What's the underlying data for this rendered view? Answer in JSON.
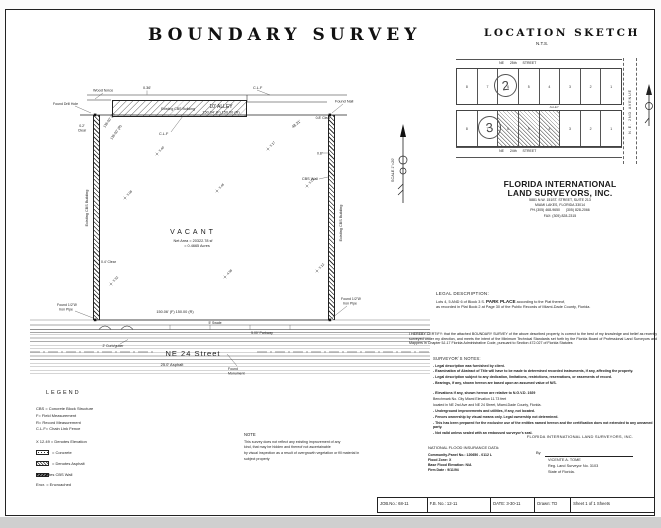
{
  "page": {
    "title": "BOUNDARY SURVEY"
  },
  "location_sketch": {
    "title": "LOCATION SKETCH",
    "nts": "N.T.S.",
    "street_top": "NE      25th      STREET",
    "street_bottom": "NE      24th      STREET",
    "alley": "ALLEY",
    "avenue": "N.E.  2ND  AVENUE",
    "block2_label": "2",
    "block3_label": "3",
    "block2_lots": [
      "8",
      "7",
      "6",
      "5",
      "4",
      "3",
      "2",
      "1"
    ],
    "block3_lots": [
      "8",
      "7",
      "6",
      "5",
      "4",
      "3",
      "2",
      "1"
    ]
  },
  "firm": {
    "name_line1": "FLORIDA INTERNATIONAL",
    "name_line2": "LAND SURVEYORS, INC.",
    "address1": "5881 N.W. 151ST. STREET, SUITE 213",
    "address2": "MIAMI LAKES, FLORIDA 33014",
    "phone": "PH.(305) 468-9650      (305) 828-2066",
    "fax": "FAX: (305) 828-2315"
  },
  "survey": {
    "scale": "SCALE 1\"=20'",
    "alley_label": "10'  ALLEY",
    "alley_dim": "150.04' (F)    150.00 (R)",
    "bottom_dim": "150.06' (F)    150.00 (R)",
    "west_dim_f": "135.00' (F)",
    "west_dim_r": "135.00' (R)",
    "vacant": "VACANT",
    "net_area_1": "Net Area = 20322.78 sf",
    "net_area_2": "= 0.4665 Acres",
    "street_name": "NE  24  Street",
    "asphalt": "25.0' Asphalt",
    "curb": "2' Curb/gutter",
    "parkway": "5.00' Parkway",
    "swale": "5' Swale",
    "wood_fence": "Wood fence",
    "fence_offset": "0.36'",
    "clf": "C.L.F",
    "found_nail": "Found Nail",
    "found_drill_hole": "Found Drill Hole",
    "found_pipe_1": "Found 1/2\"Ø",
    "found_pipe_2": "Iron Pipe",
    "monument_1": "Found",
    "monument_2": "Monument",
    "tie_4831": "48.31'",
    "clear_02a": "0.2'",
    "clear_02b": "Clear",
    "clear_04": "0.4' Clear",
    "clear_08": "0.8'  Clear",
    "dim_08": "0.8'",
    "cbs_wall": "CBS Wall",
    "existing_building": "Existing CBS Building",
    "elevations": [
      "5.08",
      "5.46",
      "5.21",
      "5.32",
      "4.98",
      "5.12",
      "5.40",
      "5.17"
    ]
  },
  "legal": {
    "heading": "LEGAL DESCRIPTION:",
    "line1_pre": "Lots 4, 5 AND 6 of Block 3 S.",
    "plat_name": "PARK PLACE",
    "line1_post": "according to the Plat thereof,",
    "line2": "as recorded in Plat Book 2 at Page  30  of the Public Records of Miami-Dade County, Florida."
  },
  "certification": "I HEREBY CERTIFY: that the attached BOUNDARY SURVEY of the above described property, is correct to the best of my knowledge and belief as recently surveyed under my direction, and meets the intent of the Minimum Technical Standards set forth by the Florida Board of Professional Land Surveyors and Mappers in Chapter 5J-17 Florida Administrative Code, pursuant to Section 472.027 of Florida Statutes",
  "notes": {
    "heading": "SURVEYOR`S NOTES:",
    "items": [
      "- Legal description was furnished by client.",
      "- Examination of Abstract of Title will have to be made to determined recorded instruments, if any, affecting the property.",
      "- Legal description subject to any dedication, limitations, restrictions, reservations, or easements of record.",
      "- Bearings, if any, shown hereon are based upon an assumed value of N/S.",
      "- Elevations if any, shown hereon are relative to N.G.V.D.  1929",
      "Benchmark No. City Miami   Elevation 11.73 feet",
      "located in NE 2nd Ave and NE 24 Street, Miami-Dade County, Florida.",
      "- Underground improvements and utilities, if any, not located.",
      "- Fences ownership by visual means only. Legal ownership not determined.",
      "- This has been prepared for the exclusive use of the entities named hereon and the certification does not extended to any unnamed party.",
      "- Not valid unless sealed with an embossed surveyor's seal."
    ]
  },
  "note_block": {
    "heading": "NOTE",
    "lines": [
      "This survey does not reflect any existing improvement of any",
      "kind, that may be hidden and thereof not ascertainable",
      "by visual inspection as a result of overgrowth vegetation or fill material in",
      "subject property"
    ]
  },
  "flood": {
    "heading": "NATIONAL FLOOD INSURANCE DATA:",
    "community_panel": "Community-Panel No.:  120650 - 0112  L",
    "flood_zone": "Flood Zone: X",
    "base_flood_elevation": "Base Flood Elevation: N/A",
    "firm_date": "Firm Date : 9/11/94"
  },
  "signature": {
    "firm": "FLORIDA INTERNATIONAL LAND SURVEYORS, INC.",
    "by": "By",
    "name": "VICENTE A. TOME",
    "reg": "Reg. Land Surveyor No. 3103",
    "state": "State of Florida."
  },
  "legend": {
    "heading": "LEGEND",
    "items": [
      "CBS = Concrete Block Structure",
      "F= Field Measurement",
      "R= Record Measurement",
      "C.L.F= Chain Link Fence"
    ],
    "elevation_item": "X 12.49  = Denotes Elevation",
    "swatch_items": [
      {
        "label": "= Concrete",
        "type": "concrete"
      },
      {
        "label": "= Denotes Asphalt",
        "type": "asphalt"
      },
      {
        "label": "= Denotes CBS Wall",
        "type": "wall"
      }
    ],
    "encr": "Encr. = Encroached"
  },
  "titleblock": {
    "job": "JOB.No.:  68-11",
    "fb": "F.B. No.: 12-11",
    "date": "DATE: 3-30-11",
    "drawn": "Drawn: TD",
    "sheet": "Sheet   1    of    1    Sheets"
  }
}
